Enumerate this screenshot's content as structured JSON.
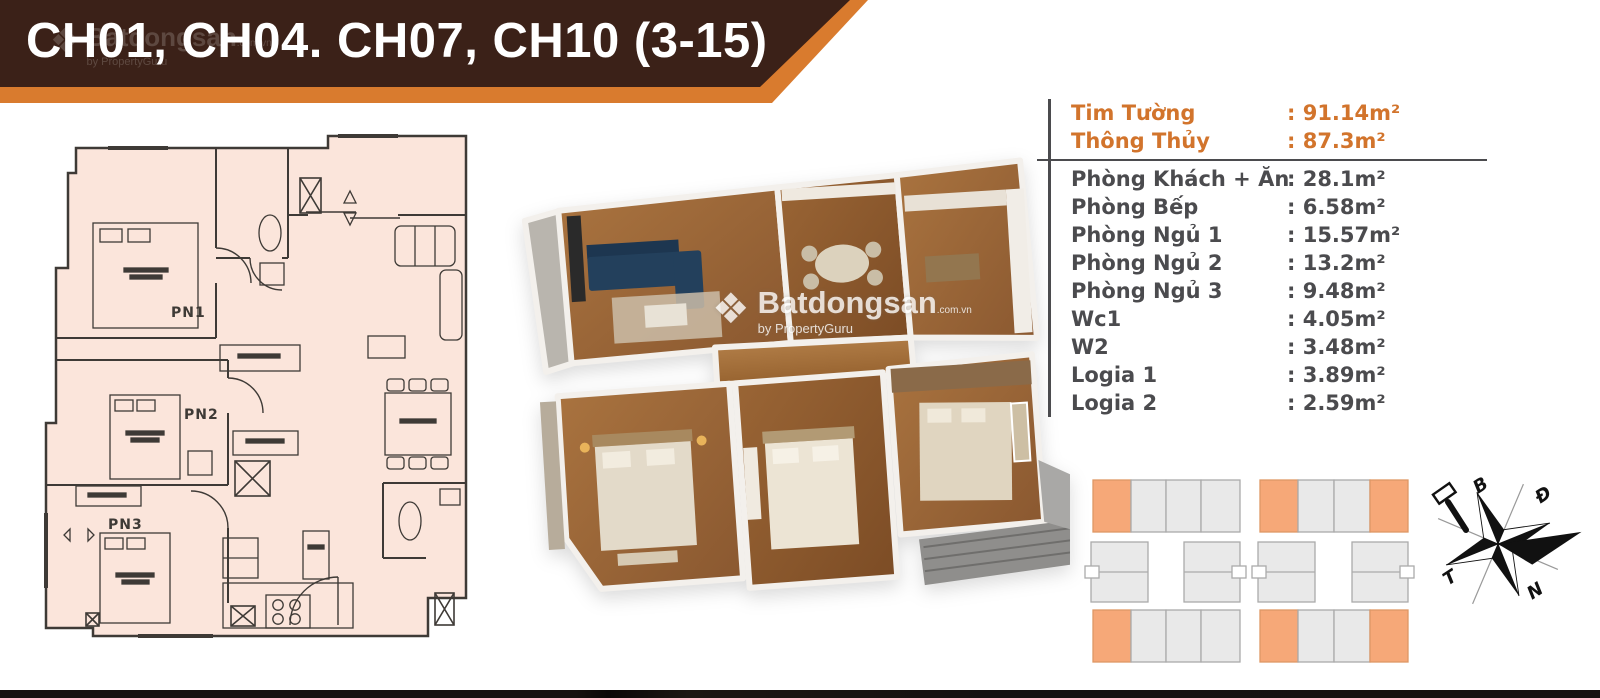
{
  "banner": {
    "title": "CH01, CH04. CH07, CH10 (3-15)",
    "bg_color": "#3B2118",
    "accent_color": "#D97B2E",
    "text_color": "#FFFFFF"
  },
  "watermark": {
    "brand": "Batdongsan",
    "domain": ".com.vn",
    "byline": "by PropertyGuru"
  },
  "floorplan_2d": {
    "fill_color": "#FBE5DB",
    "wall_color": "#3E3A36",
    "rooms": [
      {
        "label": "PN1"
      },
      {
        "label": "PN2"
      },
      {
        "label": "PN3"
      }
    ]
  },
  "area_table": {
    "accent_color": "#D2742C",
    "text_color": "#4B4B4E",
    "summary": [
      {
        "label": "Tim Tường",
        "value": ": 91.14m²"
      },
      {
        "label": "Thông Thủy",
        "value": ": 87.3m²"
      }
    ],
    "rooms": [
      {
        "label": "Phòng Khách + Ăn",
        "value": ": 28.1m²"
      },
      {
        "label": "Phòng Bếp",
        "value": ": 6.58m²"
      },
      {
        "label": "Phòng Ngủ 1",
        "value": ": 15.57m²"
      },
      {
        "label": "Phòng Ngủ 2",
        "value": ": 13.2m²"
      },
      {
        "label": "Phòng Ngủ 3",
        "value": ": 9.48m²"
      },
      {
        "label": "Wc1",
        "value": ": 4.05m²"
      },
      {
        "label": "W2",
        "value": ": 3.48m²"
      },
      {
        "label": "Logia 1",
        "value": ": 3.89m²"
      },
      {
        "label": "Logia 2",
        "value": ": 2.59m²"
      }
    ]
  },
  "site_plan": {
    "unit_fill": "#E9E9E9",
    "unit_border": "#ABABAB",
    "highlight_fill": "#F6A878",
    "highlight_border": "#DE9765"
  },
  "compass": {
    "north": "B",
    "east": "Đ",
    "west": "T",
    "south": "N"
  }
}
